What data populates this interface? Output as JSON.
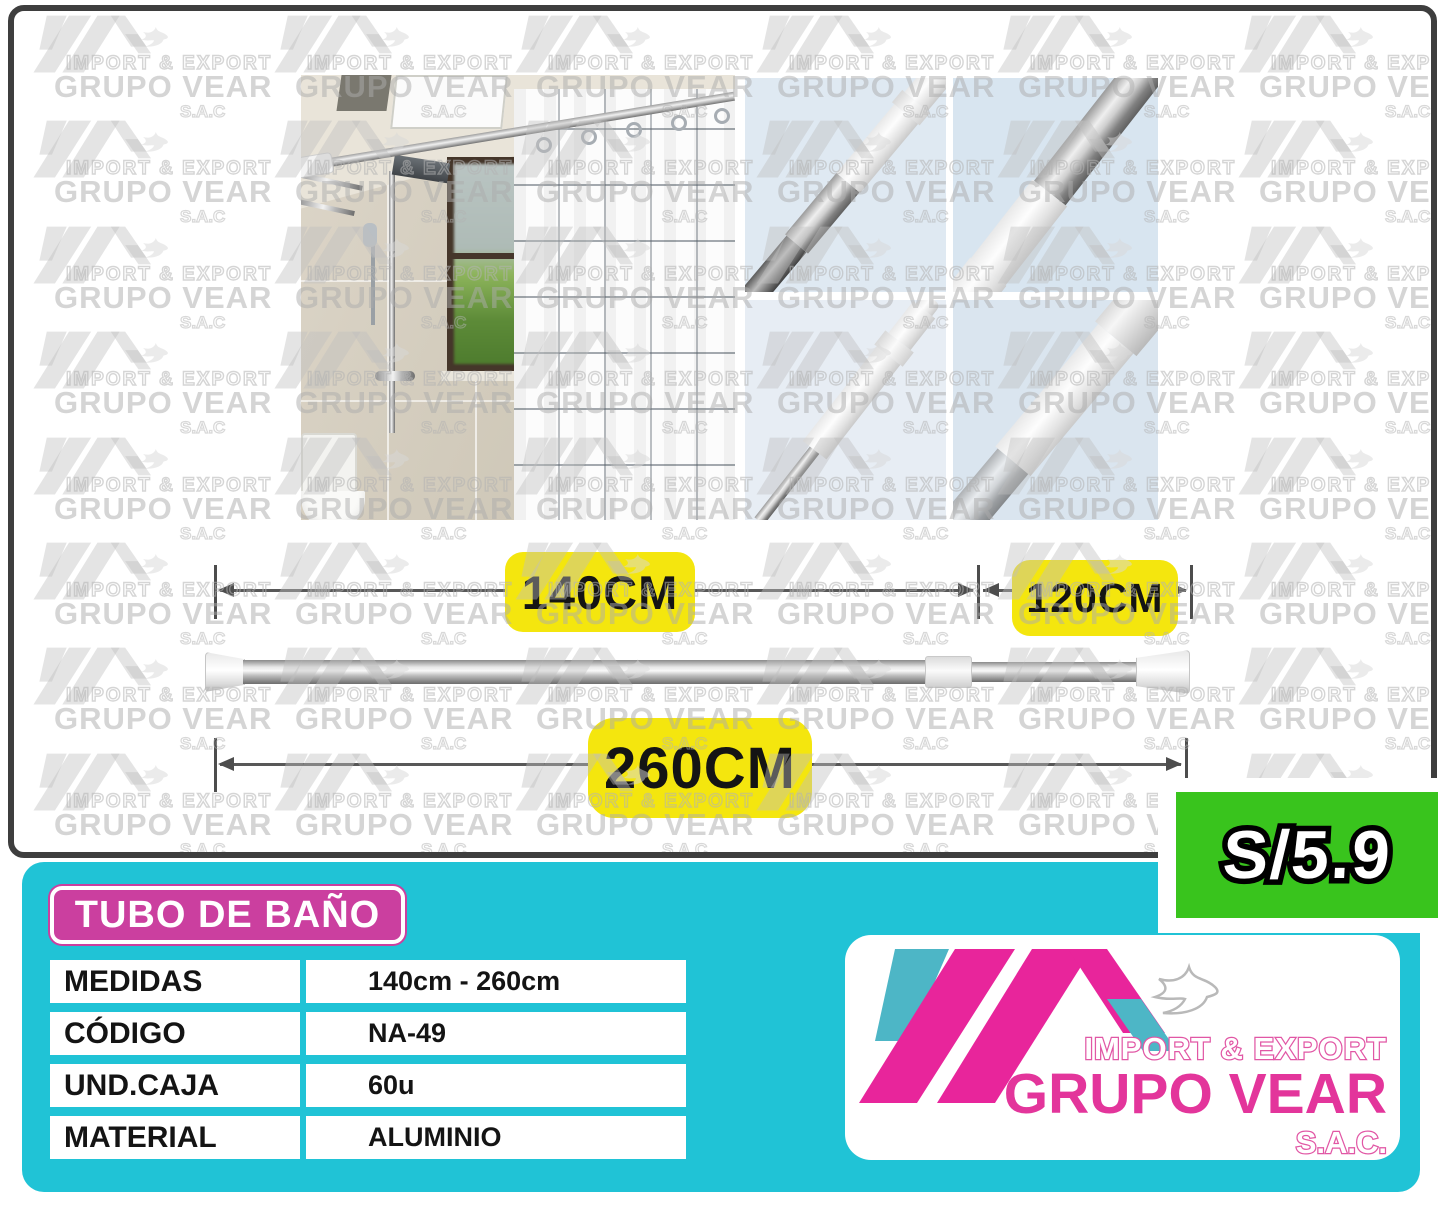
{
  "dimensions": {
    "seg1": "140CM",
    "seg2": "120CM",
    "total": "260CM"
  },
  "panel": {
    "title": "TUBO DE BAÑO",
    "specs": [
      {
        "label": "MEDIDAS",
        "value": "140cm - 260cm"
      },
      {
        "label": "CÓDIGO",
        "value": "NA-49"
      },
      {
        "label": "UND.CAJA",
        "value": "60u"
      },
      {
        "label": "MATERIAL",
        "value": "ALUMINIO"
      }
    ]
  },
  "price": {
    "label": "S/5.9"
  },
  "brand": {
    "line1": "IMPORT & EXPORT",
    "name": "GRUPO VEAR",
    "suffix": "S.A.C."
  },
  "watermark": {
    "line1": "IMPORT & EXPORT",
    "line2": "GRUPO VEAR",
    "line3": "S.A.C"
  },
  "colors": {
    "cyan": "#20c3d6",
    "magenta": "#cb3f9f",
    "green": "#39c41d",
    "yellow": "#f4e60e",
    "brand_pink": "#e3359b",
    "brand_teal": "#4db6c6"
  }
}
